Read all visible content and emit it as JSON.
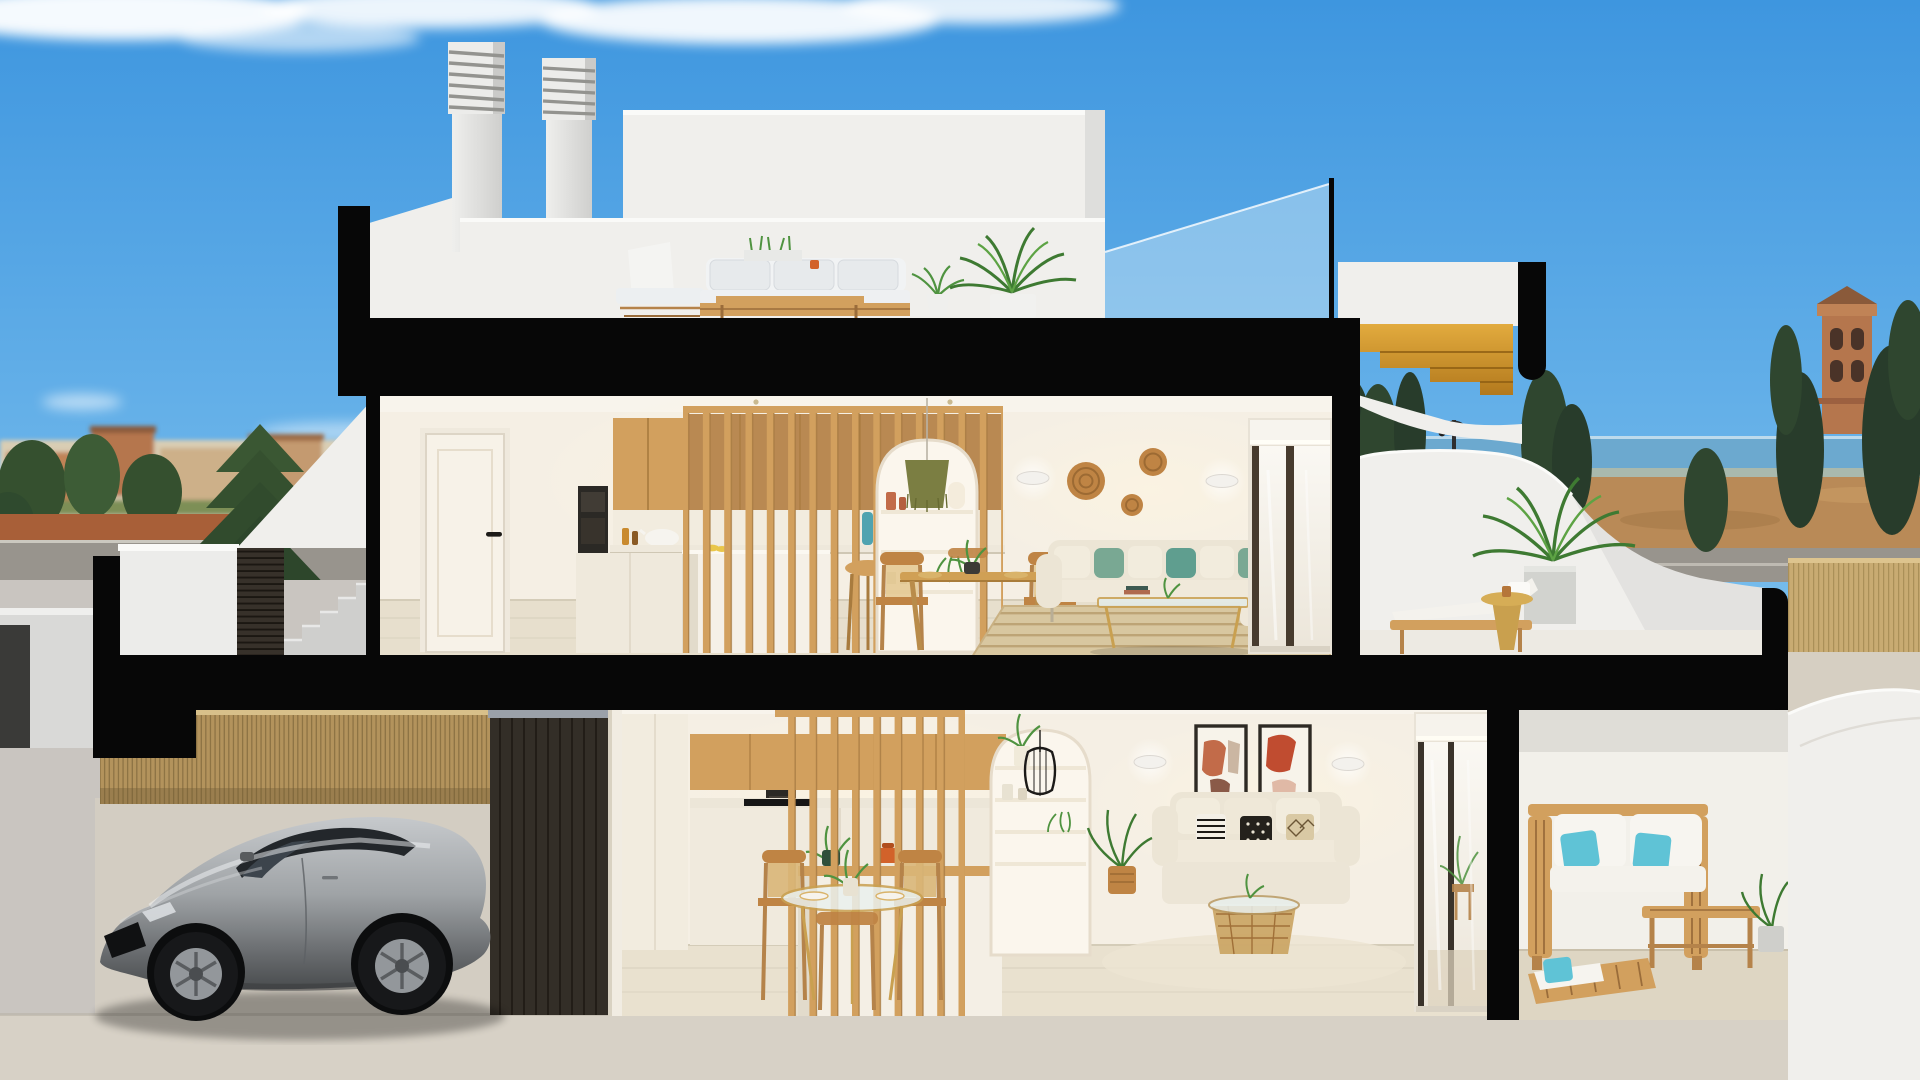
{
  "scene": {
    "title": "Two-storey coastal townhouse — architectural cross-section render",
    "description": "Photorealistic cutaway rendering of a modern white two-storey townhouse: rooftop terrace with louvered chimneys and outdoor lounge set; upper floor with kitchen, wood-slat partition, dining area with arched shelf niche, cream sofa with green cushions and a sea-view terrace with sun lounger, gold side table and palm; amber wood exterior staircase; ground floor with garage containing a silver sports car behind a bamboo fence, open-plan kitchen and glass dining table, living room with abstract art prints, and covered patio with wooden furniture and turquoise cushions; blue sky, distant town, sea, watchtower and street in the background.",
    "rooms": [
      "rooftop terrace",
      "upper-floor kitchen",
      "upper-floor dining",
      "upper-floor living room",
      "upper-floor terrace",
      "exterior staircase",
      "entry court",
      "garage",
      "ground-floor kitchen",
      "ground-floor dining",
      "ground-floor living room",
      "covered patio",
      "neighbour patio"
    ],
    "objects": [
      "louvered chimney",
      "outdoor sofa set",
      "potted palm",
      "glass railing",
      "wood stair",
      "sun lounger",
      "gold pedestal table",
      "white door",
      "built-in oven",
      "wood slat screen",
      "kitchen island",
      "dining set",
      "arched niche",
      "green pendant lamp",
      "rattan wall baskets",
      "wall sconces",
      "cream sofa",
      "glass coffee table",
      "jute rug",
      "sliding glass door",
      "bamboo fence",
      "silver sports coupe",
      "dark slatted gate",
      "concrete steps",
      "black cage pendant",
      "abstract art prints",
      "round glass dining table",
      "woven coffee table",
      "teak sofa",
      "teak lounger",
      "watchtower",
      "street lamp"
    ]
  },
  "colors": {
    "sky_top": "#3e96df",
    "sky_low": "#b5ddf4",
    "cloud": "#ffffff",
    "black": "#070707",
    "ext_white": "#f0efec",
    "ext_bright": "#fafaf8",
    "ext_shade": "#d8d8d6",
    "wall": "#f5efe4",
    "wall_deep": "#eae2d2",
    "ceiling": "#f8f4ec",
    "floor": "#e7dfcd",
    "floor_lower": "#e9e1cf",
    "wood": "#d2a05e",
    "wood_deep": "#b5834a",
    "amber": "#d79b2c",
    "dark_slats": "#332e27",
    "bamboo": "#b3935c",
    "bamboo_light": "#c8ab72",
    "cream": "#ece5d5",
    "green": "#79a893",
    "teal": "#5fc3d6",
    "rug": "#d8c7a0",
    "rattan": "#bf8444",
    "glass": "#cfe7f4",
    "sea": "#6ca9cf",
    "terra": "#b5764d",
    "town": "#d9cdb4",
    "tree": "#35502f",
    "tree_dark": "#283c2b",
    "road": "#98948d",
    "redwalk": "#a85f38",
    "pave": "#c9c5c0",
    "pave_warm": "#d6cfc2",
    "silver": "#9fa3a6",
    "silver_hi": "#c6c9cc",
    "silver_lo": "#494c4e",
    "tire": "#17181a",
    "gold": "#c9a04e",
    "olive": "#7b7e42",
    "pot_orange": "#d2622a",
    "leaf": "#4f9340",
    "art_terra": "#c26b49"
  }
}
